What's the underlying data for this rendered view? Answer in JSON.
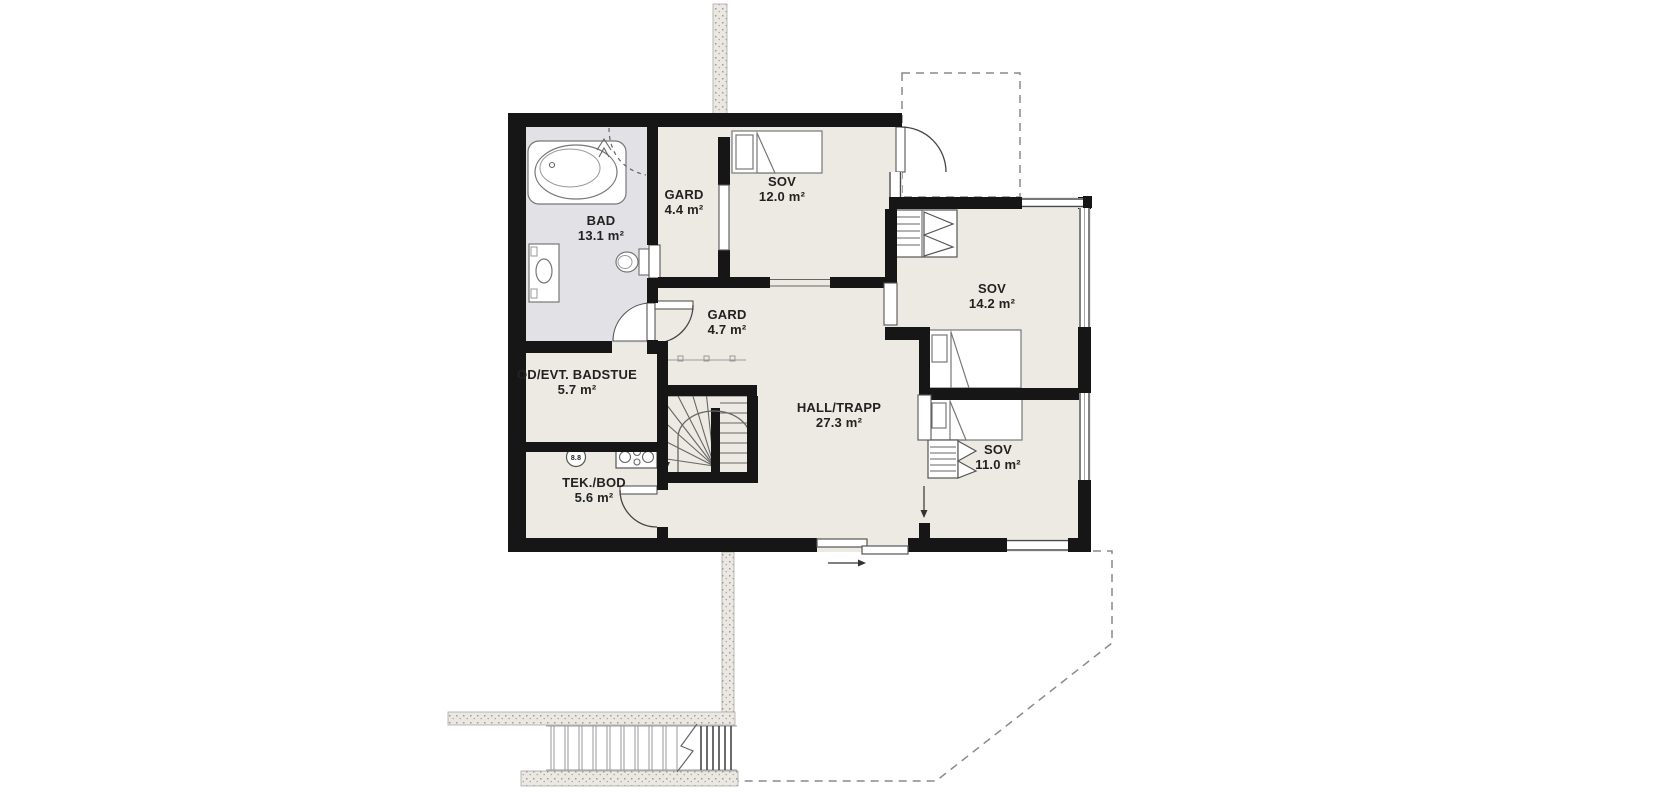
{
  "plan": {
    "rooms": [
      {
        "key": "bad",
        "name": "BAD",
        "area": "13.1 m²"
      },
      {
        "key": "gard-44",
        "name": "GARD",
        "area": "4.4 m²"
      },
      {
        "key": "sov-120",
        "name": "SOV",
        "area": "12.0 m²"
      },
      {
        "key": "sov-142",
        "name": "SOV",
        "area": "14.2 m²"
      },
      {
        "key": "gard-47",
        "name": "GARD",
        "area": "4.7 m²"
      },
      {
        "key": "bod-badstue",
        "name": "OD/EVT. BADSTUE",
        "area": "5.7 m²"
      },
      {
        "key": "hall-trapp",
        "name": "HALL/TRAPP",
        "area": "27.3 m²"
      },
      {
        "key": "tek-bod",
        "name": "TEK./BOD",
        "area": "5.6 m²"
      },
      {
        "key": "sov-110",
        "name": "SOV",
        "area": "11.0 m²"
      }
    ],
    "labels": {
      "water_heater": "8.8"
    },
    "colors": {
      "wall": "#161616",
      "floor": "#eceae2",
      "bathroom_floor": "#e2e2e6",
      "line": "#555555",
      "dashed": "#8a8a8a",
      "text": "#222222"
    }
  }
}
